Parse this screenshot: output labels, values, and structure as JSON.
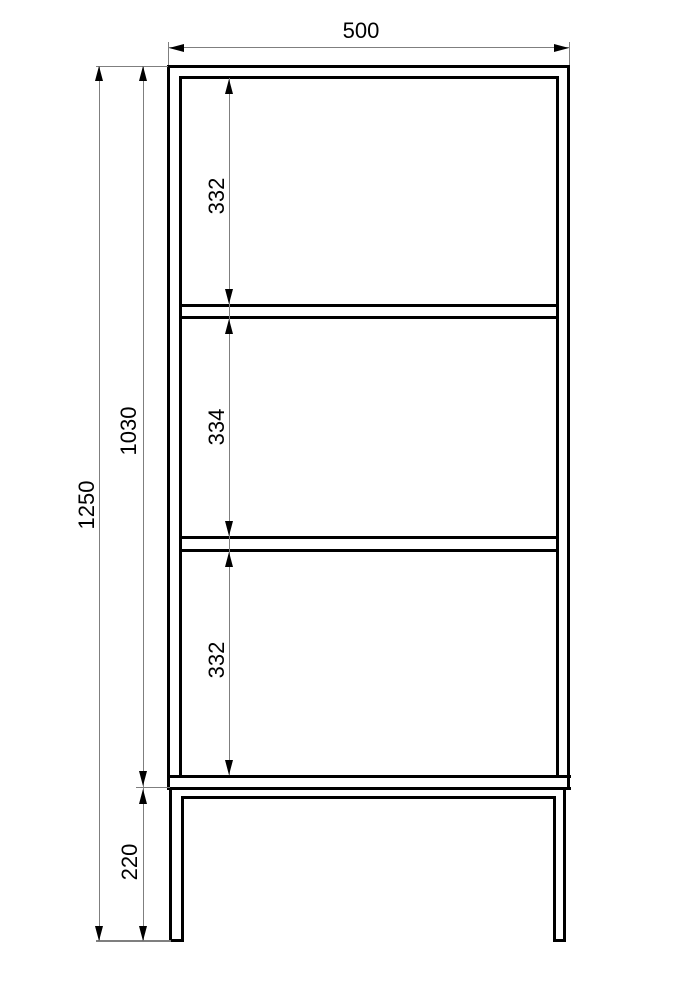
{
  "drawing": {
    "labels": {
      "width": "500",
      "total_height": "1250",
      "body_height": "1030",
      "section_top": "332",
      "section_middle": "334",
      "section_bottom": "332",
      "leg_height": "220"
    }
  }
}
